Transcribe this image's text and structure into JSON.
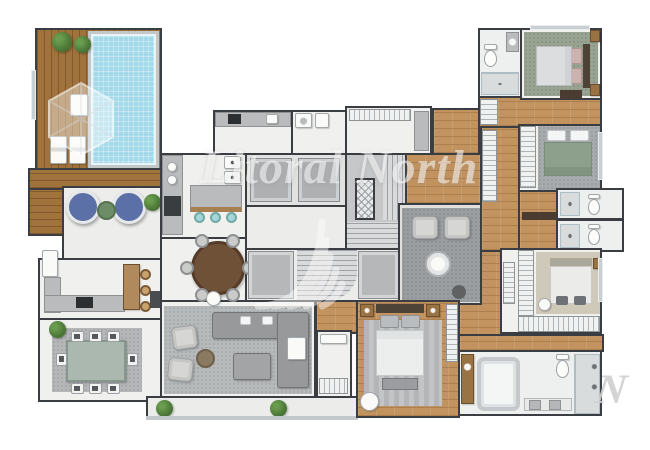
{
  "watermark": {
    "brand_text": "Litoral North",
    "corner_letter": "N",
    "text_color": "rgba(255,255,255,0.55)"
  },
  "palette": {
    "wall": "#3a3d42",
    "floor": "#f0f0ee",
    "wood_deck": "#a0723c",
    "wood_floor": "#c3935f",
    "pool_water": "#a4d9ea",
    "pool_frame": "#c2c7ca",
    "carpet_living": "#b7babb",
    "carpet_sitting": "#9b9ea0",
    "rug_green": "#99a391",
    "carpet_beige": "#cfc9b9",
    "rug_bedroom_gray": "#a8abad",
    "rug_master": "#b8babc",
    "sofa": "#97999a",
    "armchair": "#d6d7d5",
    "egg_chair_blue": "#5c70a8",
    "stool_teal": "#a5d6d6",
    "bed_green": "#8da08c",
    "bed_pink": "#cdb3af",
    "plant_green": "#4f7c3a",
    "table_wood": "#6f5138",
    "counter_gray": "#b9bbbd"
  },
  "icons": {
    "parasol-icon": "hexagon-with-spokes",
    "plant-icon": "organic-green-circle",
    "pool-icon": "tiled-blue-rect",
    "egg-chair-icon": "ring-circle",
    "lounger-icon": "striped-rounded-rect",
    "elevator-icon": "framed-gray-square",
    "elevator-shaft-icon": "cross-hatched-rect",
    "stairs-icon": "striped-treads",
    "sofa-icon": "l-shape-gray",
    "armchair-icon": "rounded-square",
    "bed-icon": "rect-with-pillows",
    "toilet-icon": "ellipse-with-tank",
    "shower-icon": "tiled-square",
    "bathtub-icon": "rounded-rect",
    "washer-icon": "box-with-ring",
    "wardrobe-icon": "rung-strip",
    "dining-table-icon": "rect-top",
    "round-table-icon": "dark-circle",
    "kitchen-island-icon": "counter-with-stools",
    "cooktop-icon": "dark-square-dots",
    "sink-icon": "white-circle",
    "window-icon": "light-gray-band"
  }
}
